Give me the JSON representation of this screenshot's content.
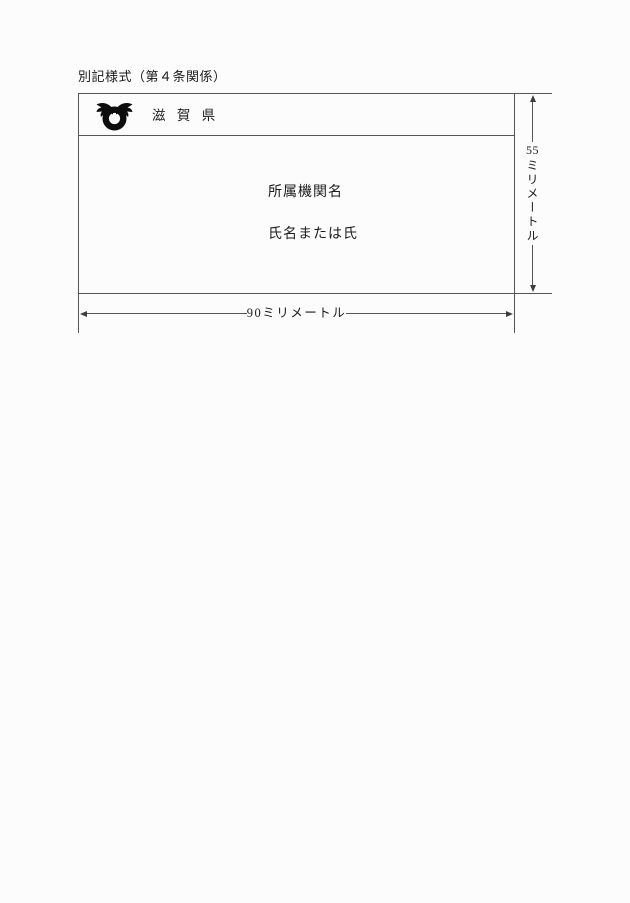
{
  "document": {
    "title": "別記様式（第４条関係）"
  },
  "badge": {
    "prefecture_name": "滋 賀 県",
    "organization_label": "所属機関名",
    "name_label": "氏名または氏",
    "emblem": "shiga-prefecture-emblem"
  },
  "dimensions": {
    "height_value": "55",
    "height_unit": "ミリメートル",
    "width_label": "90ミリメートル"
  },
  "colors": {
    "background": "#fcfcfc",
    "line": "#555555",
    "text": "#1b1b1b",
    "emblem": "#0d0d0d"
  }
}
